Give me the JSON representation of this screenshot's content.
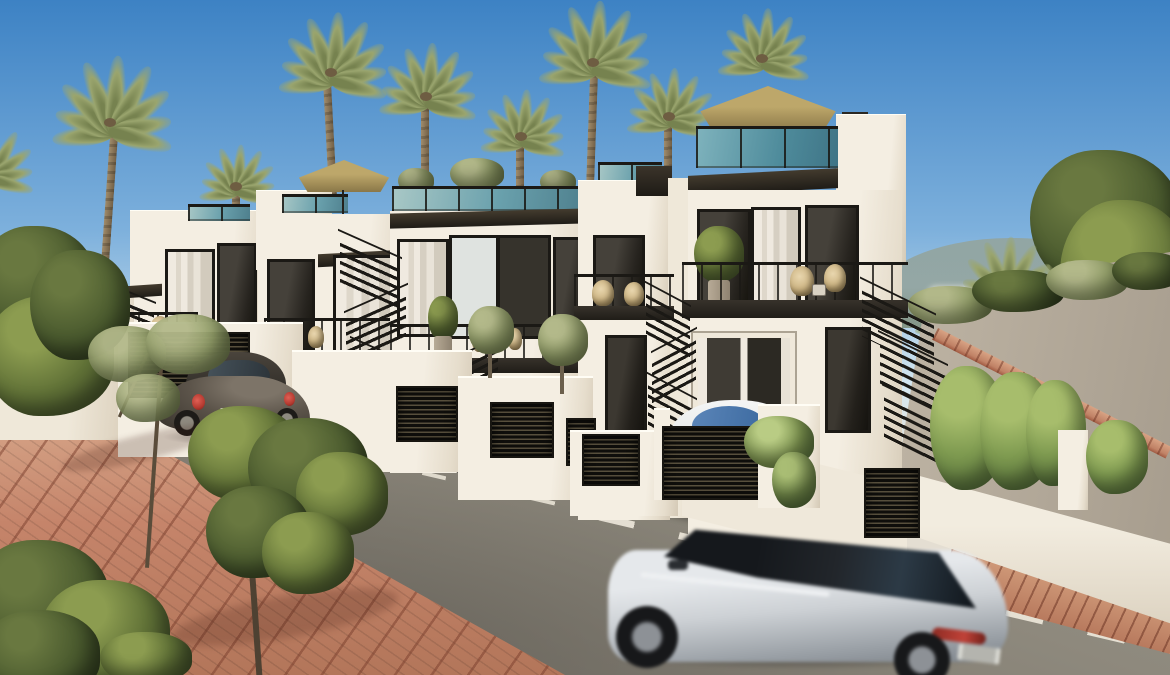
{
  "scene": {
    "label": "New-build townhouse development — exterior street view",
    "description": "Sunny photorealistic 3D architectural rendering of a row of modern white three-storey townhouses with roof terraces, tan patio umbrellas, teal glass balustrades, black exterior staircases and louvered gates; palm trees behind, terracotta brick sidewalk and asphalt street with dashed white center line; a dark parked Beetle, a white car behind a driveway gate and a motion-blurred grey SUV driving past; side lane rising to the right between hedges toward distant green hills",
    "time_of_day": "daytime, clear blue sky",
    "visible_text": "none (license plates present but illegible)"
  },
  "palette": {
    "sky-top": "#3d82c4",
    "sky-mid": "#7db0dc",
    "sky-low": "#d7e8f0",
    "wall-lit": "#f4eee2",
    "wall-mid": "#e6ddcc",
    "wall-shade": "#d4c9b6",
    "glass-teal-1": "#69a0ac",
    "glass-teal-2": "#a9c8c6",
    "umbrella-1": "#bda76a",
    "umbrella-2": "#8a7748",
    "palm-1": "#9aa56e",
    "palm-2": "#76824f",
    "tree-lt": "#8c9c50",
    "tree-md": "#5f7036",
    "tree-dk": "#42502a",
    "hedge-1": "#7e9a50",
    "hedge-2": "#55703a",
    "brick": "#c08266",
    "brick-lt": "#d8a384",
    "brick-dk": "#a05a42",
    "road-1": "#9a948a",
    "road-2": "#7b766c",
    "ramp-1": "#bfb5a5",
    "ramp-2": "#a79d8e",
    "hill": "#93a49e",
    "line": "#efe9dc",
    "dark-frame": "#1b1915",
    "beetle": "#5c544a",
    "suv-body": "#cdd1d5",
    "suv-roof": "#22262b",
    "white-car": "#eaeceb",
    "taillight": "#b43a30"
  },
  "objects": {
    "sky": {
      "label": "clear blue sky gradient"
    },
    "hills": {
      "label": "distant green hills at right horizon"
    },
    "buildings": {
      "label": "five stepped white modern townhouses",
      "count": 5,
      "features": [
        "roof terraces with teal glass railings and planters",
        "two tan patio umbrellas on roof terraces",
        "black metal exterior zigzag staircases",
        "balconies with rattan chairs, side tables and potted olive trees",
        "dark louvered garage gates and utility panels in white garden walls",
        "floor-to-ceiling sliding windows with white curtains",
        "chimney on the tallest right unit",
        "dark roof fascias / overhangs"
      ]
    },
    "umbrellas": {
      "count": 2,
      "color": "#bda76a",
      "positions": [
        "left roof terrace",
        "tallest right roof terrace"
      ]
    },
    "vegetation": {
      "palm_trees": {
        "count": 12,
        "color": "#9aa56e",
        "placement": "behind buildings and right slope"
      },
      "hedges": {
        "color": "#7e9a50",
        "placement": "right of stairs and along ramp"
      },
      "street_trees": {
        "count": 2,
        "placement": "on brick sidewalk, lower left"
      },
      "bushes": {
        "placement": "lower-left corner, left of buildings, hanging ivy on driveway wall"
      }
    },
    "street": {
      "road_color": "#8e897d",
      "marking": "dashed white center line receding from left to lower right",
      "sidewalk": "terracotta brick paving with diagonal joint lines, lower left and right strip",
      "curb": "red brick curb along far side of road",
      "ramp": "beige lane rising to the right with red brick edge"
    },
    "vehicles": [
      {
        "name": "parked-beetle",
        "type": "dark compact car parked at curb, rear three-quarter view",
        "color": "#5c544a",
        "details": [
          "red taillights",
          "white license plate",
          "dark roof"
        ]
      },
      {
        "name": "parked-white-car",
        "type": "white car parked in driveway behind dark louvered gate",
        "color": "#eaeceb",
        "details": [
          "blue-tinted windshield reflection"
        ]
      },
      {
        "name": "moving-suv",
        "type": "light grey compact SUV driving past, motion-blurred",
        "color": "#cdd1d5",
        "roof": "#22262b",
        "details": [
          "black roof and glass band",
          "red taillight strip",
          "white license plate",
          "dark alloy wheels"
        ]
      }
    ]
  }
}
